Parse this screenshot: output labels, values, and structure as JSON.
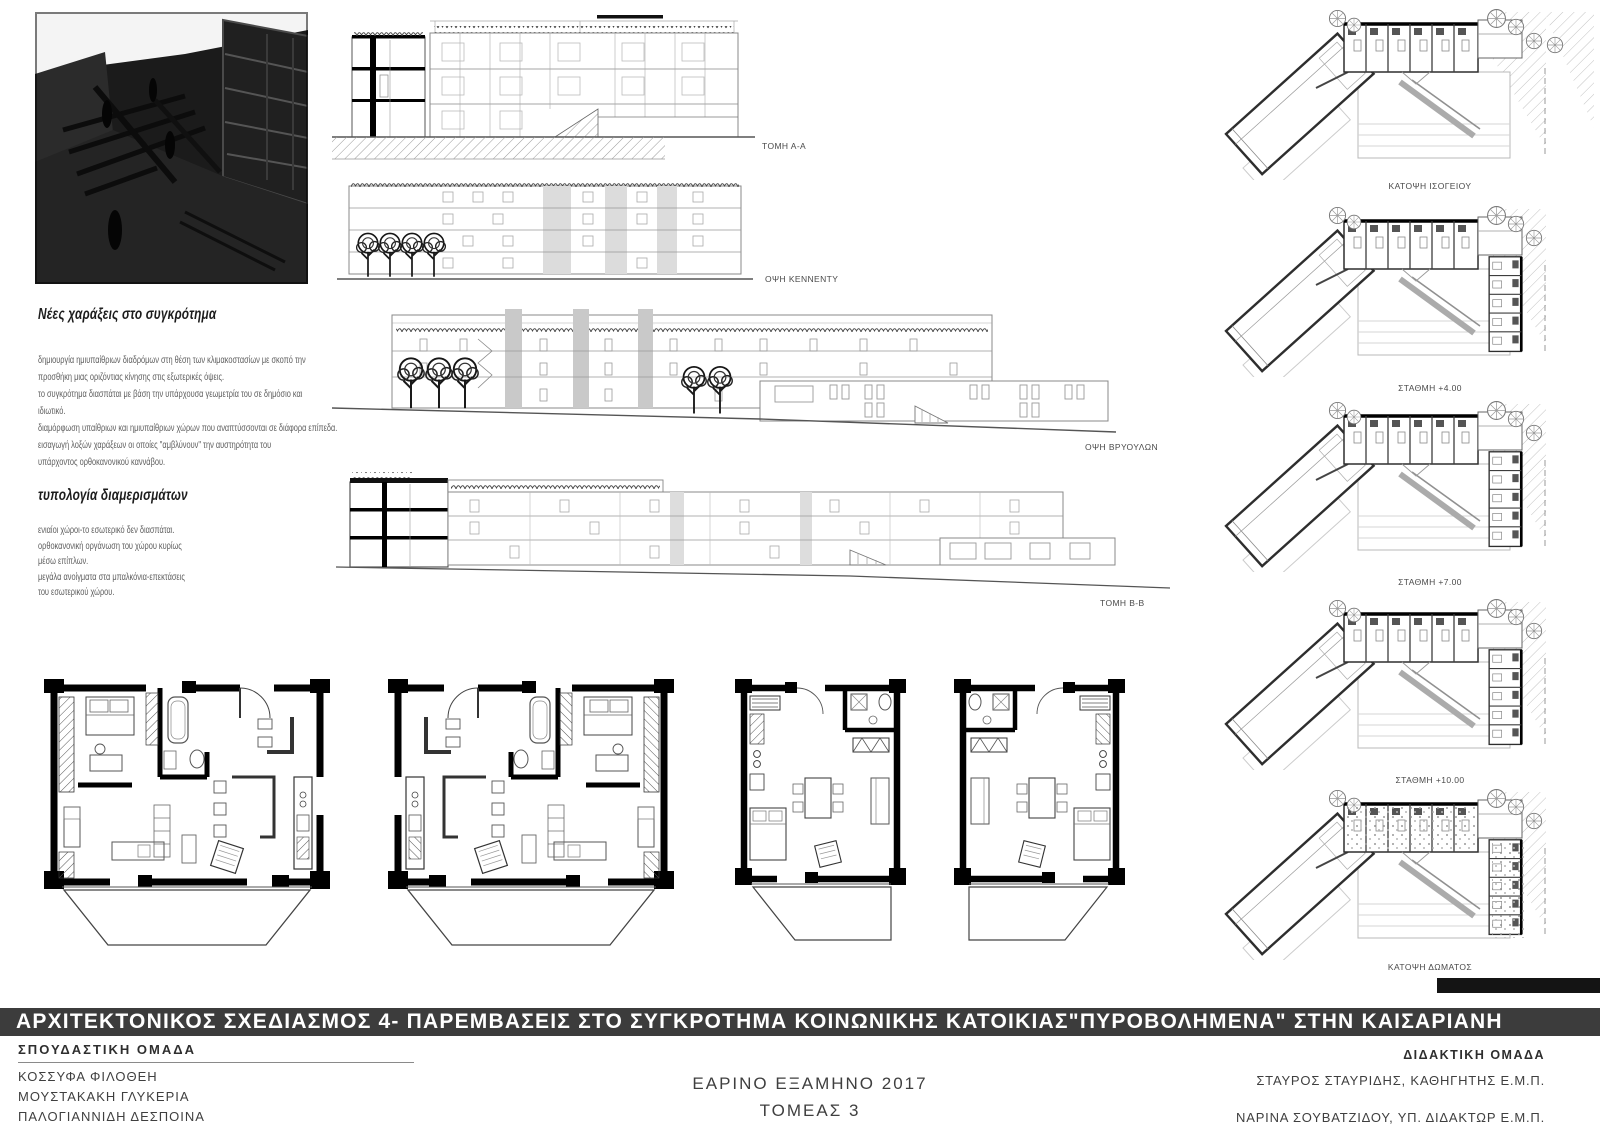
{
  "notes": {
    "heading_new_tracings": "Νέες χαράξεις στο συγκρότημα",
    "para1_lines": [
      "δημιουργία ημιυπαίθριων διαδρόμων στη θέση των κλιμακοστασίων με σκοπό την",
      "προσθήκη μιας οριζόντιας κίνησης στις εξωτερικές όψεις.",
      "το συγκρότημα διασπάται με βάση την υπάρχουσα γεωμετρία του σε δημόσιο και",
      "ιδιωτικό.",
      "διαμόρφωση υπαίθριων και ημιυπαίθριων χώρων που αναπτύσσονται σε διάφορα επίπεδα.",
      "εισαγωγή λοξών χαράξεων οι οποίες \"αμβλύνουν\" την αυστηρότητα του",
      "υπάρχοντος ορθοκανονικού καννάβου."
    ],
    "heading_typology": "τυπολογία διαμερισμάτων",
    "para2_lines": [
      "ενιαίοι χώροι-το εσωτερικό δεν διασπάται.",
      "ορθοκανονική οργάνωση του χώρου κυρίως",
      "μέσω επίπλων.",
      "μεγάλα ανοίγματα στα μπαλκόνια-επεκτάσεις",
      "του εσωτερικού χώρου."
    ]
  },
  "drawings": {
    "sections": [
      {
        "label": "ΤΟΜΗ Α-Α"
      },
      {
        "label": "ΟΨΗ ΚΕΝΝΕΝΤΥ"
      },
      {
        "label": "ΟΨΗ ΒΡΥΟΥΛΩΝ"
      },
      {
        "label": "ΤΟΜΗ Β-Β"
      }
    ],
    "floor_plans": [
      {
        "label": "ΚΑΤΟΨΗ ΙΣΟΓΕΙΟΥ"
      },
      {
        "label": "ΣΤΑΘΜΗ +4.00"
      },
      {
        "label": "ΣΤΑΘΜΗ +7.00"
      },
      {
        "label": "ΣΤΑΘΜΗ +10.00"
      },
      {
        "label": "ΚΑΤΟΨΗ ΔΩΜΑΤΟΣ"
      }
    ]
  },
  "footer": {
    "title": "ΑΡΧΙΤΕΚΤΟΝΙΚΟΣ ΣΧΕΔΙΑΣΜΟΣ 4- ΠΑΡΕΜΒΑΣΕΙΣ ΣΤΟ ΣΥΓΚΡΟΤΗΜΑ ΚΟΙΝΩΝΙΚΗΣ ΚΑΤΟΙΚΙΑΣ\"ΠΥΡΟΒΟΛΗΜΕΝΑ\" ΣΤΗΝ ΚΑΙΣΑΡΙΑΝΗ",
    "students_heading": "ΣΠΟΥΔΑΣΤΙΚΗ ΟΜΑΔΑ",
    "students": [
      "ΚΟΣΣΥΦΑ ΦΙΛΟΘΕΗ",
      "ΜΟΥΣΤΑΚΑΚΗ ΓΛΥΚΕΡΙΑ",
      "ΠΑΛΟΓΙΑΝΝΙΔΗ ΔΕΣΠΟΙΝΑ"
    ],
    "semester": "ΕΑΡΙΝΟ ΕΞΑΜΗΝΟ 2017",
    "sector": "ΤΟΜΕΑΣ 3",
    "teachers_heading": "ΔΙΔΑΚΤΙΚΗ ΟΜΑΔΑ",
    "teachers": [
      "ΣΤΑΥΡΟΣ ΣΤΑΥΡΙΔΗΣ, ΚΑΘΗΓΗΤΗΣ Ε.Μ.Π.",
      "ΝΑΡΙΝΑ ΣΟΥΒΑΤΖΙΔΟΥ, ΥΠ. ΔΙΔΑΚΤΩΡ Ε.Μ.Π."
    ]
  },
  "colors": {
    "title_bar_bg": "#3c3c3c",
    "stair_core_gray": "#c9c9c9",
    "poche_black": "#000000"
  }
}
